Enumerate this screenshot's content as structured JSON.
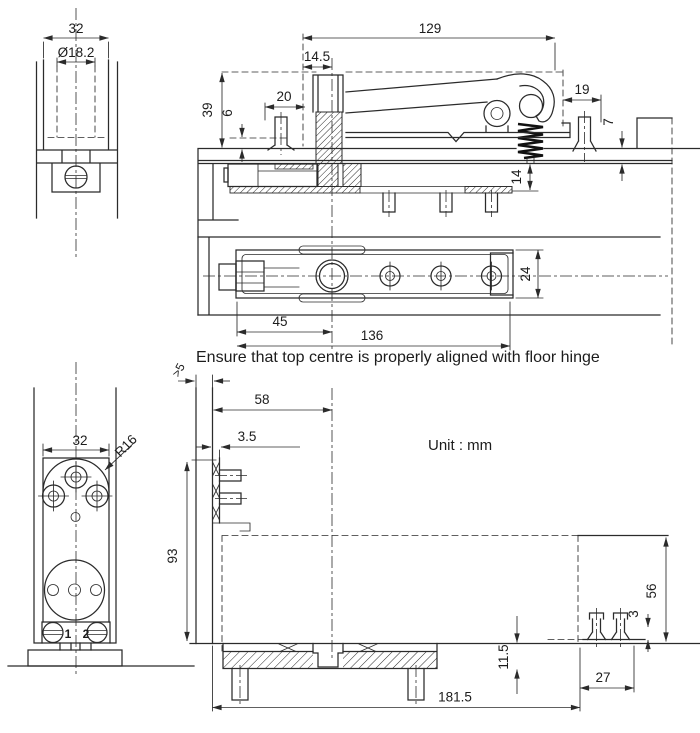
{
  "note": "Ensure that top centre is properly aligned with floor hinge",
  "unit_label": "Unit : mm",
  "labels": {
    "top_front": {
      "width": "32",
      "diameter": "Ø18.2"
    },
    "top_section": {
      "overall_129": "129",
      "offset_14_5": "14.5",
      "height_39": "39",
      "inset_6": "6",
      "stud_20": "20",
      "end_19": "19",
      "lip_7": "7",
      "plate_14": "14"
    },
    "top_plan": {
      "pivot_45": "45",
      "length_136": "136",
      "width_24": "24"
    },
    "bottom_front": {
      "width": "32",
      "radius": "R16",
      "screw_1": "1",
      "screw_2": "2"
    },
    "bottom_plan": {
      "clearance": ">5",
      "offset_58": "58",
      "thickness_3_5": "3.5",
      "height_93": "93",
      "cover_56": "56",
      "head_3": "3",
      "span_27": "27",
      "length_181_5": "181.5",
      "depth_11_5": "11.5"
    }
  }
}
